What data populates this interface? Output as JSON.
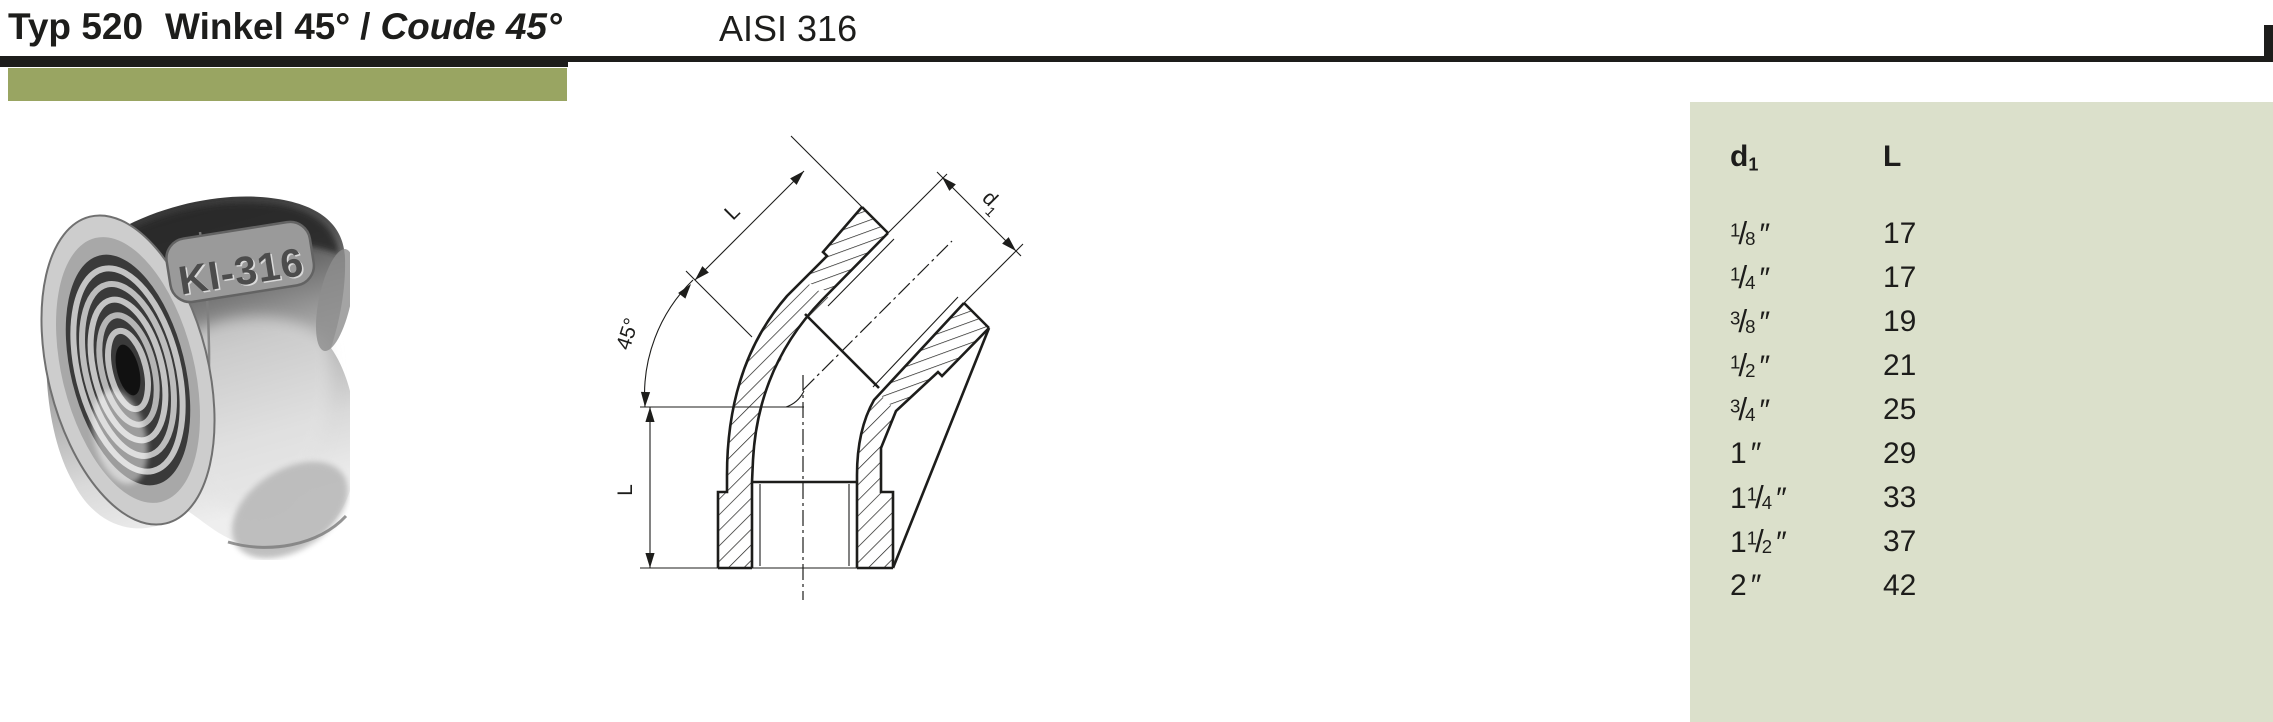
{
  "header": {
    "type_label": "Typ 520",
    "title_de": "Winkel 45°",
    "title_separator": "/",
    "title_fr": "Coude 45°",
    "material": "AISI 316"
  },
  "photo": {
    "stamp_text": "KI-316"
  },
  "drawing": {
    "top_length_label": "L",
    "left_length_label": "L",
    "angle_label": "45°",
    "diameter_label": "d",
    "diameter_sub": "1"
  },
  "table": {
    "header": {
      "d1_main": "d",
      "d1_sub": "1",
      "l_label": "L"
    },
    "frac_slash": "/",
    "rows": [
      {
        "whole": "",
        "num": "1",
        "den": "8",
        "unit": "″",
        "L": "17"
      },
      {
        "whole": "",
        "num": "1",
        "den": "4",
        "unit": "″",
        "L": "17"
      },
      {
        "whole": "",
        "num": "3",
        "den": "8",
        "unit": "″",
        "L": "19"
      },
      {
        "whole": "",
        "num": "1",
        "den": "2",
        "unit": "″",
        "L": "21"
      },
      {
        "whole": "",
        "num": "3",
        "den": "4",
        "unit": "″",
        "L": "25"
      },
      {
        "whole": "1",
        "num": "",
        "den": "",
        "unit": "″",
        "L": "29"
      },
      {
        "whole": "1",
        "num": "1",
        "den": "4",
        "unit": "″",
        "L": "33"
      },
      {
        "whole": "1",
        "num": "1",
        "den": "2",
        "unit": "″",
        "L": "37"
      },
      {
        "whole": "2",
        "num": "",
        "den": "",
        "unit": "″",
        "L": "42"
      }
    ]
  },
  "colors": {
    "ink": "#1d1d1b",
    "accent_olive": "#99a562",
    "panel_sage": "#dbe0cb"
  }
}
